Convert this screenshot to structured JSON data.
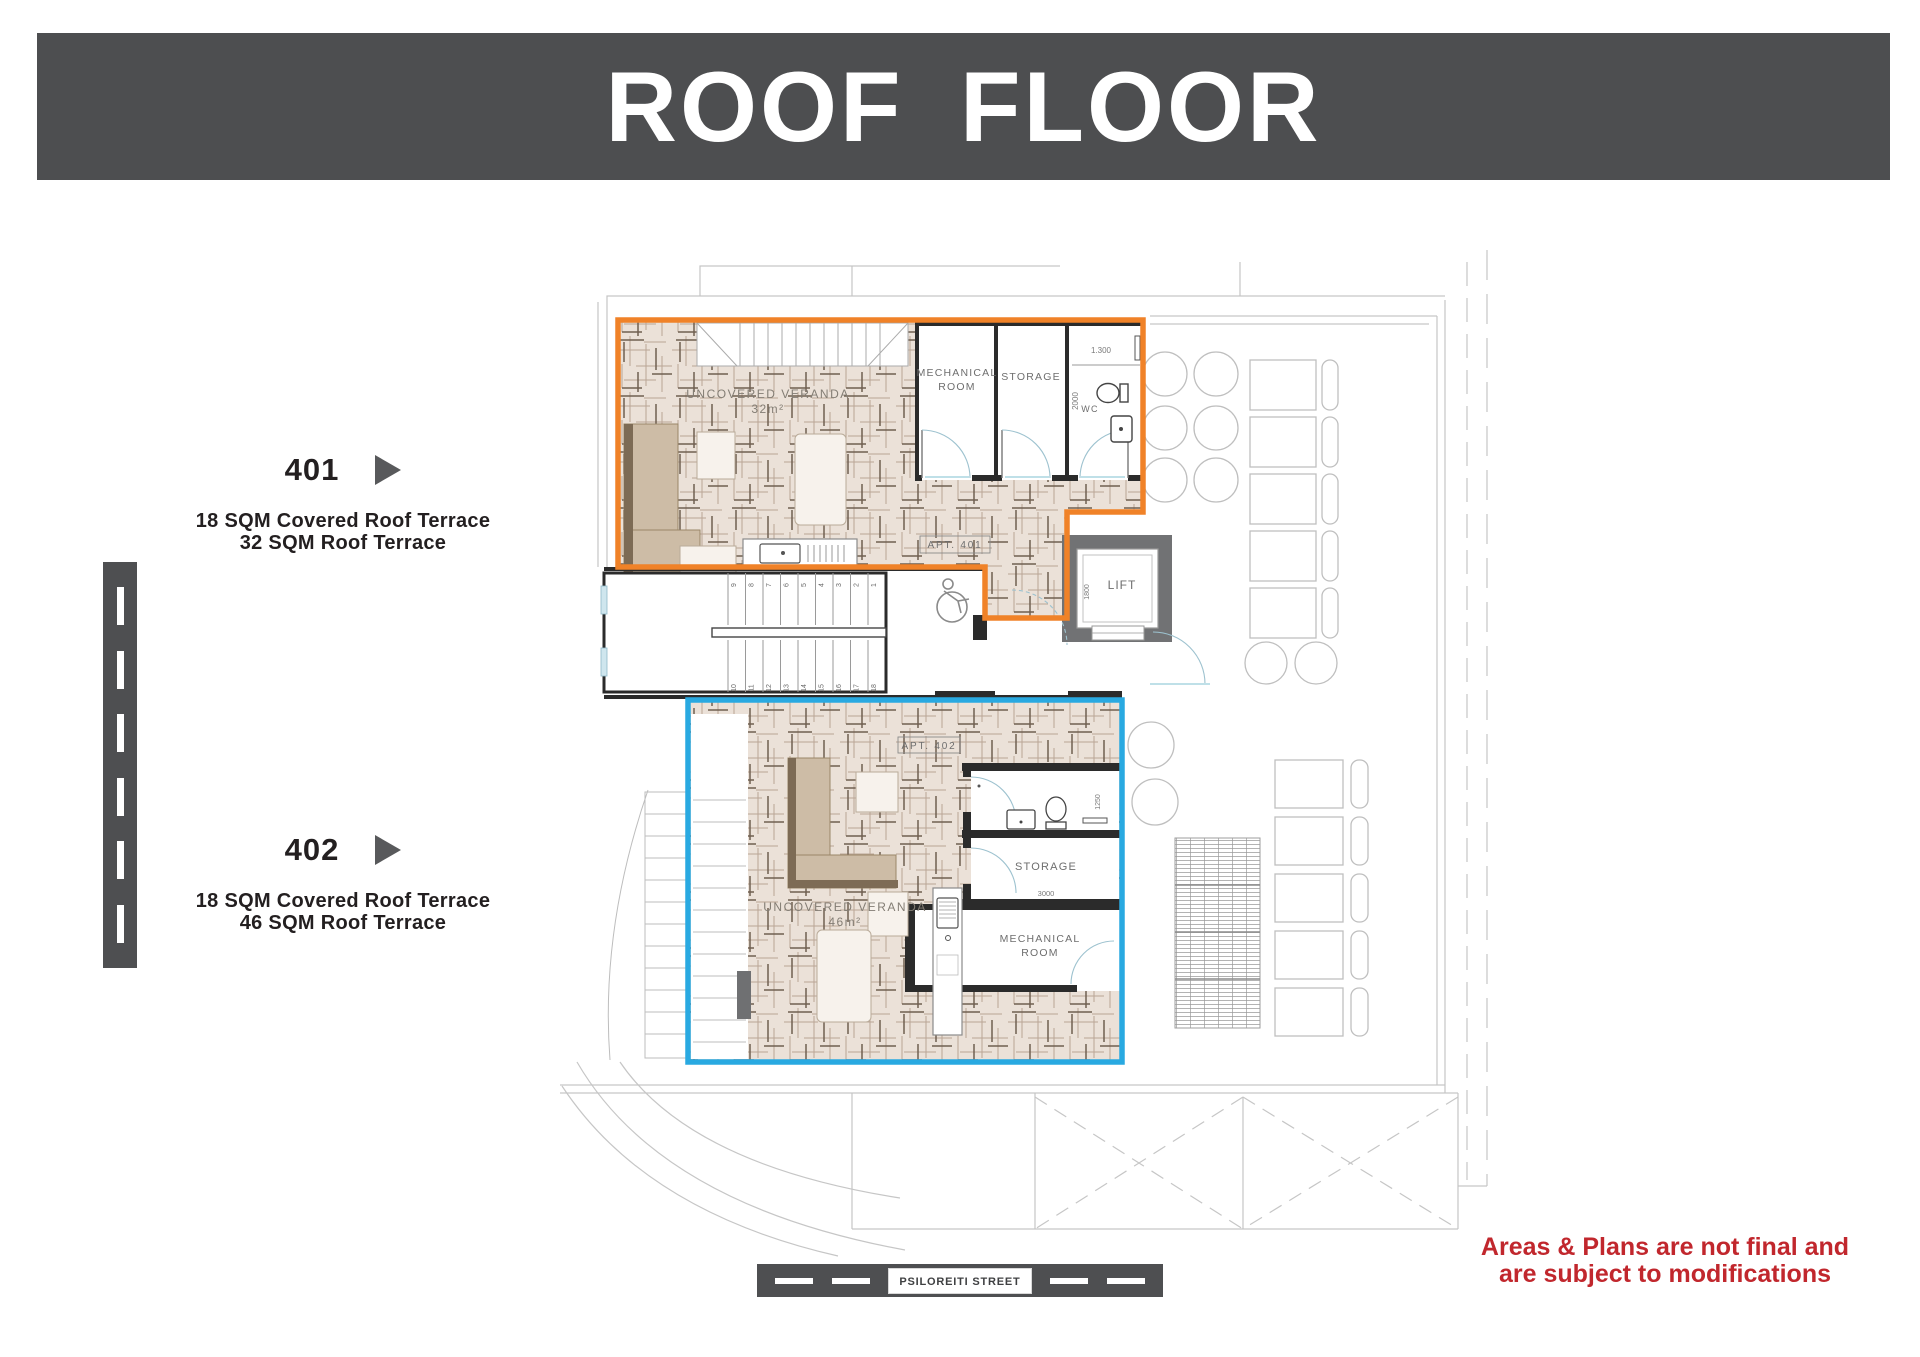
{
  "header": {
    "title": "ROOF FLOOR"
  },
  "units": [
    {
      "number": "401",
      "desc_lines": [
        "18 SQM Covered Roof Terrace",
        "32 SQM Roof Terrace"
      ]
    },
    {
      "number": "402",
      "desc_lines": [
        "18 SQM Covered Roof Terrace",
        "46 SQM Roof Terrace"
      ]
    }
  ],
  "plan": {
    "apt401": {
      "tag": "APT. 401",
      "veranda_label": "UNCOVERED VERANDA",
      "veranda_area": "32m²",
      "mech_line1": "MECHANICAL",
      "mech_line2": "ROOM",
      "storage": "STORAGE",
      "wc": "WC",
      "dim_wc_width": "1.300",
      "dim_wc_depth": "2000"
    },
    "apt402": {
      "tag": "APT. 402",
      "veranda_label": "UNCOVERED VERANDA",
      "veranda_area": "46m²",
      "mech_line1": "MECHANICAL",
      "mech_line2": "ROOM",
      "storage": "STORAGE",
      "dim_storage": "3000",
      "dim_wc": "1250"
    },
    "lift": {
      "label": "LIFT",
      "dim": "1800"
    },
    "stairs": {
      "top_row": [
        "9",
        "8",
        "7",
        "6",
        "5",
        "4",
        "3",
        "2",
        "1"
      ],
      "bottom_row": [
        "10",
        "11",
        "12",
        "13",
        "14",
        "15",
        "16",
        "17",
        "18"
      ]
    }
  },
  "street": {
    "name": "PSILOREITI STREET"
  },
  "disclaimer": {
    "line1": "Areas & Plans are not final and",
    "line2": "are subject to modifications"
  },
  "colors": {
    "banner_gray": "#4d4e50",
    "road_gray": "#4e4f51",
    "apt401_outline": "#f08228",
    "apt402_outline": "#29a9e1",
    "disclaimer_red": "#c1272d",
    "tile_fill": "#ebe1d8"
  }
}
